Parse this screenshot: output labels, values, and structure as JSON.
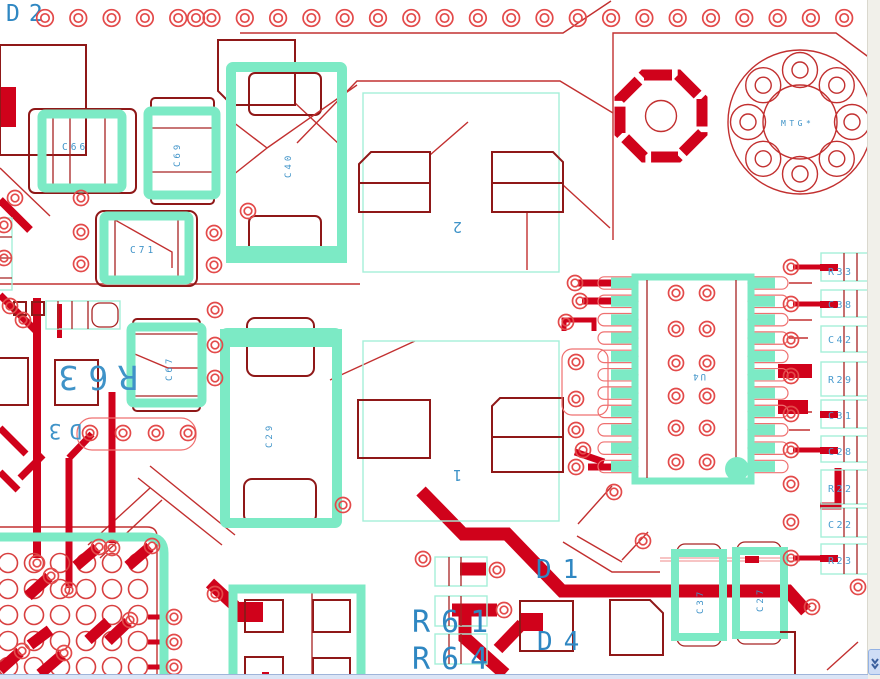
{
  "view": {
    "description_hint": "PCB layout canvas"
  },
  "colors": {
    "copper": "#d0021b",
    "trace_outline": "#c23030",
    "pad_outline": "#8f1818",
    "via_ring": "#e34a4a",
    "highlight_teal": "#7ceac5",
    "courtyard_cyan": "#a5efd9",
    "refdes_blue": "#3f93c8",
    "refdes_blue_large": "#2f87c2",
    "background": "#ffffff"
  },
  "labels": {
    "d2": "D2",
    "c66": "C66",
    "c69": "C69",
    "c40": "C40",
    "c71": "C71",
    "c67": "C67",
    "c29": "C29",
    "l2_pin": "2",
    "l1_pin": "1",
    "mtg": "MTG*",
    "u4": "U4",
    "r63": "R63",
    "d3": "D3",
    "d1": "D1",
    "d4": "D4",
    "r61": "R61",
    "r64": "R64",
    "c37": "C37",
    "c27": "C27"
  },
  "right_column": {
    "items": [
      {
        "label": "R33"
      },
      {
        "label": "C38"
      },
      {
        "label": "C42"
      },
      {
        "label": "R29"
      },
      {
        "label": "C31"
      },
      {
        "label": "C28"
      },
      {
        "label": "R22"
      },
      {
        "label": "C22"
      },
      {
        "label": "R23"
      }
    ]
  },
  "scrollbar": {
    "down_icon": "chevron-down"
  }
}
